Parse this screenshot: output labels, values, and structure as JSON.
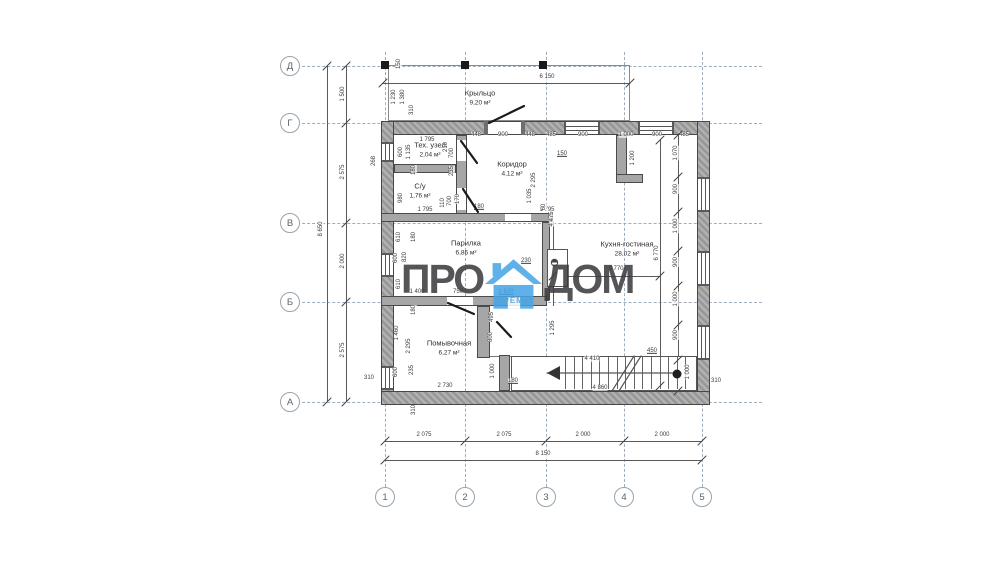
{
  "watermark": {
    "left": "ПРО",
    "right": "ДОМ",
    "sub": "РЕМ",
    "accent": "#47a5e7",
    "text_color": "#3a3a3c"
  },
  "axes": {
    "rows": [
      [
        "Д",
        290,
        66
      ],
      [
        "Г",
        290,
        123
      ],
      [
        "В",
        290,
        223
      ],
      [
        "Б",
        290,
        302
      ],
      [
        "А",
        290,
        402
      ]
    ],
    "cols": [
      [
        "1",
        385,
        497
      ],
      [
        "2",
        465,
        497
      ],
      [
        "3",
        546,
        497
      ],
      [
        "4",
        624,
        497
      ],
      [
        "5",
        702,
        497
      ]
    ]
  },
  "rooms": [
    [
      "Крыльцо",
      "9,20 м²",
      480,
      93
    ],
    [
      "Тех. узел",
      "2,04 м²",
      430,
      145
    ],
    [
      "Коридор",
      "4,12 м²",
      512,
      164
    ],
    [
      "С/у",
      "1,76 м²",
      420,
      186
    ],
    [
      "Парилка",
      "6,86 м²",
      466,
      243
    ],
    [
      "Кухня-гостиная",
      "28,02 м²",
      627,
      244
    ],
    [
      "Помывочная",
      "6,27 м²",
      449,
      343
    ]
  ],
  "labels": [
    [
      "6 150",
      547,
      77,
      0,
      0
    ],
    [
      "1 795",
      427,
      140,
      0,
      0
    ],
    [
      "448",
      476,
      135,
      0,
      0
    ],
    [
      "900",
      503,
      135,
      0,
      0
    ],
    [
      "448",
      530,
      135,
      0,
      0
    ],
    [
      "485",
      551,
      135,
      0,
      0
    ],
    [
      "900",
      583,
      135,
      0,
      0
    ],
    [
      "1 000",
      626,
      135,
      0,
      0
    ],
    [
      "900",
      657,
      135,
      0,
      0
    ],
    [
      "485",
      684,
      135,
      0,
      0
    ],
    [
      "150",
      399,
      64,
      1,
      0
    ],
    [
      "1 230",
      394,
      97,
      1,
      0
    ],
    [
      "1 380",
      403,
      97,
      1,
      0
    ],
    [
      "310",
      412,
      110,
      1,
      0
    ],
    [
      "1 500",
      343,
      94,
      1,
      0
    ],
    [
      "2 575",
      343,
      172,
      1,
      0
    ],
    [
      "2 000",
      343,
      261,
      1,
      0
    ],
    [
      "2 575",
      343,
      350,
      1,
      0
    ],
    [
      "8 650",
      321,
      229,
      1,
      0
    ],
    [
      "268",
      374,
      161,
      1,
      0
    ],
    [
      "310",
      369,
      378,
      0,
      0
    ],
    [
      "310",
      414,
      410,
      1,
      0
    ],
    [
      "600",
      401,
      152,
      1,
      0
    ],
    [
      "1 135",
      409,
      152,
      1,
      0
    ],
    [
      "180",
      414,
      170,
      1,
      0
    ],
    [
      "210",
      446,
      147,
      1,
      0
    ],
    [
      "700",
      452,
      153,
      1,
      0
    ],
    [
      "235",
      452,
      171,
      1,
      0
    ],
    [
      "980",
      401,
      198,
      1,
      0
    ],
    [
      "110",
      443,
      203,
      1,
      0
    ],
    [
      "700",
      450,
      201,
      1,
      0
    ],
    [
      "170",
      458,
      199,
      1,
      0
    ],
    [
      "1 795",
      425,
      210,
      0,
      0
    ],
    [
      "180",
      479,
      207,
      0,
      1
    ],
    [
      "1 795",
      547,
      210,
      0,
      0
    ],
    [
      "1 200",
      633,
      158,
      1,
      0
    ],
    [
      "150",
      562,
      154,
      0,
      1
    ],
    [
      "1 035",
      530,
      196,
      1,
      0
    ],
    [
      "60",
      544,
      207,
      1,
      0
    ],
    [
      "4 475",
      552,
      219,
      1,
      0
    ],
    [
      "2 295",
      534,
      180,
      1,
      0
    ],
    [
      "610",
      399,
      237,
      1,
      0
    ],
    [
      "180",
      414,
      237,
      1,
      0
    ],
    [
      "600",
      396,
      258,
      1,
      0
    ],
    [
      "820",
      405,
      257,
      1,
      0
    ],
    [
      "610",
      399,
      284,
      1,
      0
    ],
    [
      "1 400",
      417,
      292,
      0,
      0
    ],
    [
      "750",
      458,
      292,
      0,
      0
    ],
    [
      "1 620",
      506,
      292,
      0,
      1
    ],
    [
      "230",
      526,
      261,
      0,
      1
    ],
    [
      "180",
      414,
      310,
      1,
      0
    ],
    [
      "1 460",
      397,
      333,
      1,
      0
    ],
    [
      "2 295",
      409,
      346,
      1,
      0
    ],
    [
      "600",
      396,
      372,
      1,
      0
    ],
    [
      "235",
      412,
      370,
      1,
      0
    ],
    [
      "495",
      492,
      317,
      1,
      0
    ],
    [
      "800",
      491,
      337,
      1,
      0
    ],
    [
      "1 000",
      493,
      371,
      1,
      0
    ],
    [
      "1 295",
      553,
      328,
      1,
      0
    ],
    [
      "180",
      513,
      381,
      0,
      1
    ],
    [
      "2 730",
      445,
      386,
      0,
      0
    ],
    [
      "4 410",
      592,
      359,
      0,
      0
    ],
    [
      "4 860",
      600,
      388,
      0,
      0
    ],
    [
      "450",
      652,
      351,
      0,
      1
    ],
    [
      "3 770",
      616,
      269,
      0,
      0
    ],
    [
      "6 770",
      657,
      253,
      1,
      0
    ],
    [
      "1 070",
      676,
      153,
      1,
      0
    ],
    [
      "900",
      676,
      189,
      1,
      0
    ],
    [
      "1 000",
      676,
      226,
      1,
      0
    ],
    [
      "900",
      676,
      262,
      1,
      0
    ],
    [
      "1 000",
      676,
      299,
      1,
      0
    ],
    [
      "900",
      676,
      335,
      1,
      0
    ],
    [
      "1 000",
      688,
      372,
      1,
      0
    ],
    [
      "310",
      716,
      381,
      0,
      0
    ],
    [
      "2 075",
      424,
      435,
      0,
      0
    ],
    [
      "2 075",
      504,
      435,
      0,
      0
    ],
    [
      "2 000",
      583,
      435,
      0,
      0
    ],
    [
      "2 000",
      662,
      435,
      0,
      0
    ],
    [
      "8 150",
      543,
      454,
      0,
      0
    ]
  ],
  "plan": {
    "grid": {
      "v": [
        385,
        465,
        546,
        624,
        702
      ],
      "v_y": [
        52,
        487
      ],
      "h": [
        66,
        123,
        223,
        302,
        402
      ],
      "h_x": [
        282,
        762
      ]
    },
    "dim_lines": [
      [
        "h",
        383,
        83,
        247
      ],
      [
        "h",
        385,
        441,
        317
      ],
      [
        "h",
        385,
        460,
        317
      ],
      [
        "h",
        553,
        276,
        107
      ],
      [
        "h",
        490,
        356,
        25
      ],
      [
        "v",
        327,
        66,
        336
      ],
      [
        "v",
        346,
        66,
        336
      ],
      [
        "v",
        660,
        140,
        246
      ],
      [
        "v",
        678,
        135,
        256
      ],
      [
        "v",
        553,
        222,
        84
      ]
    ],
    "ticks": [
      [
        385,
        441
      ],
      [
        465,
        441
      ],
      [
        546,
        441
      ],
      [
        624,
        441
      ],
      [
        702,
        441
      ],
      [
        385,
        460
      ],
      [
        702,
        460
      ],
      [
        383,
        83
      ],
      [
        630,
        83
      ],
      [
        346,
        66
      ],
      [
        346,
        123
      ],
      [
        346,
        223
      ],
      [
        346,
        302
      ],
      [
        346,
        402
      ],
      [
        327,
        66
      ],
      [
        327,
        402
      ],
      [
        553,
        276
      ],
      [
        660,
        276
      ],
      [
        678,
        135
      ],
      [
        678,
        177
      ],
      [
        678,
        212
      ],
      [
        678,
        251
      ],
      [
        678,
        286
      ],
      [
        678,
        325
      ],
      [
        678,
        360
      ],
      [
        678,
        391
      ],
      [
        660,
        140
      ],
      [
        660,
        386
      ]
    ],
    "walls_ext": [
      [
        381,
        121,
        329,
        14
      ],
      [
        381,
        121,
        13,
        284
      ],
      [
        697,
        121,
        13,
        284
      ],
      [
        381,
        391,
        329,
        14
      ]
    ],
    "walls_int": [
      [
        456,
        135,
        11,
        87
      ],
      [
        394,
        164,
        62,
        9
      ],
      [
        381,
        213,
        172,
        9
      ],
      [
        616,
        135,
        11,
        47
      ],
      [
        616,
        174,
        27,
        9
      ],
      [
        542,
        222,
        8,
        78
      ],
      [
        381,
        296,
        166,
        10
      ],
      [
        477,
        306,
        13,
        52
      ],
      [
        499,
        355,
        11,
        36
      ]
    ],
    "openings": [
      [
        487,
        122,
        35,
        12
      ],
      [
        457,
        140,
        9,
        21
      ],
      [
        457,
        188,
        9,
        22
      ],
      [
        505,
        214,
        26,
        7
      ],
      [
        447,
        297,
        26,
        8
      ]
    ],
    "windows": [
      [
        564,
        122,
        36,
        12,
        "h"
      ],
      [
        638,
        122,
        36,
        12,
        "h"
      ],
      [
        382,
        142,
        11,
        20,
        "v"
      ],
      [
        382,
        253,
        11,
        24,
        "v"
      ],
      [
        382,
        366,
        11,
        24,
        "v"
      ],
      [
        698,
        177,
        11,
        35,
        "v"
      ],
      [
        698,
        251,
        11,
        35,
        "v"
      ],
      [
        698,
        325,
        11,
        35,
        "v"
      ]
    ],
    "jambs": [
      [
        484,
        121,
        4,
        14
      ],
      [
        521,
        121,
        4,
        14
      ]
    ],
    "porch": {
      "rect": [
        388,
        65,
        242,
        56
      ],
      "columns": [
        [
          381,
          61
        ],
        [
          461,
          61
        ],
        [
          539,
          61
        ]
      ]
    },
    "stove": {
      "rect": [
        547,
        249,
        21,
        38
      ],
      "circle": [
        554.5,
        262.5
      ]
    },
    "stairs": {
      "rect": [
        511,
        356,
        186,
        35
      ],
      "tread_x0": 565,
      "tread_dx": 8.6,
      "tread_n": 15,
      "lines": [
        [
          547,
          373,
          672,
          373
        ],
        [
          612,
          391,
          634,
          356
        ],
        [
          619,
          391,
          641,
          356
        ]
      ],
      "arrow": "547,373 560,366 560,380",
      "circle": [
        677,
        374
      ]
    },
    "doors": [
      [
        489,
        123,
        524,
        106
      ],
      [
        461,
        141,
        477,
        163
      ],
      [
        463,
        189,
        478,
        212
      ],
      [
        448,
        303,
        474,
        314
      ],
      [
        497,
        322,
        511,
        337
      ]
    ]
  }
}
